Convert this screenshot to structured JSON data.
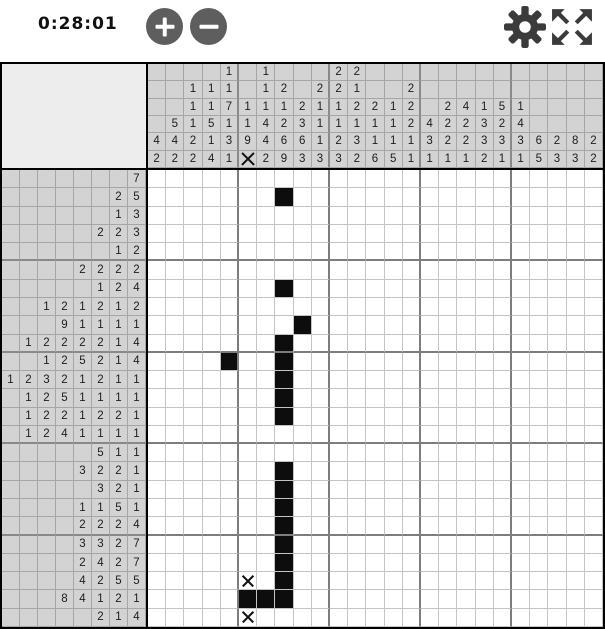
{
  "toolbar": {
    "timer": "0:28:01",
    "zoom_in": "zoom in",
    "zoom_out": "zoom out",
    "settings": "settings",
    "fullscreen": "fullscreen"
  },
  "colors": {
    "filled_cell": "#0d0d0d",
    "clue_background": "#d3d3d3",
    "corner_background": "#ededed",
    "button_gray": "#5e5e5e",
    "icon_gray": "#3b3b3b"
  },
  "puzzle": {
    "grid": {
      "rows": 25,
      "cols": 25
    },
    "column_clues": [
      [
        "4",
        "2"
      ],
      [
        "5",
        "4",
        "2"
      ],
      [
        "1",
        "1",
        "1",
        "2",
        "2"
      ],
      [
        "1",
        "1",
        "5",
        "1",
        "4"
      ],
      [
        "1",
        "1",
        "7",
        "1",
        "3",
        "1"
      ],
      [
        "1",
        "1",
        "9",
        "X"
      ],
      [
        "1",
        "1",
        "1",
        "4",
        "4",
        "2"
      ],
      [
        "2",
        "1",
        "2",
        "6",
        "9"
      ],
      [
        "2",
        "3",
        "6",
        "3"
      ],
      [
        "2",
        "1",
        "1",
        "1",
        "3"
      ],
      [
        "2",
        "2",
        "1",
        "1",
        "2",
        "3"
      ],
      [
        "2",
        "1",
        "2",
        "1",
        "3",
        "2"
      ],
      [
        "2",
        "1",
        "1",
        "6"
      ],
      [
        "1",
        "1",
        "1",
        "5"
      ],
      [
        "2",
        "2",
        "2",
        "1",
        "1"
      ],
      [
        "4",
        "3",
        "1"
      ],
      [
        "2",
        "2",
        "2",
        "1"
      ],
      [
        "4",
        "2",
        "2",
        "1"
      ],
      [
        "1",
        "3",
        "3",
        "2"
      ],
      [
        "5",
        "2",
        "3",
        "1"
      ],
      [
        "1",
        "4",
        "3",
        "1"
      ],
      [
        "6",
        "5"
      ],
      [
        "2",
        "3"
      ],
      [
        "8",
        "3"
      ],
      [
        "2",
        "2"
      ]
    ],
    "row_clues": [
      [
        "7"
      ],
      [
        "2",
        "5"
      ],
      [
        "1",
        "3"
      ],
      [
        "2",
        "2",
        "3"
      ],
      [
        "1",
        "2"
      ],
      [
        "2",
        "2",
        "2",
        "2"
      ],
      [
        "1",
        "2",
        "4"
      ],
      [
        "1",
        "2",
        "1",
        "2",
        "1",
        "2"
      ],
      [
        "9",
        "1",
        "1",
        "1",
        "1"
      ],
      [
        "1",
        "2",
        "2",
        "2",
        "2",
        "1",
        "4"
      ],
      [
        "1",
        "2",
        "5",
        "2",
        "1",
        "4"
      ],
      [
        "1",
        "2",
        "3",
        "2",
        "1",
        "2",
        "1",
        "1"
      ],
      [
        "1",
        "2",
        "5",
        "1",
        "1",
        "1",
        "1"
      ],
      [
        "1",
        "2",
        "2",
        "1",
        "2",
        "2",
        "1"
      ],
      [
        "1",
        "2",
        "4",
        "1",
        "1",
        "1",
        "1"
      ],
      [
        "5",
        "1",
        "1"
      ],
      [
        "3",
        "2",
        "2",
        "1"
      ],
      [
        "3",
        "2",
        "1"
      ],
      [
        "1",
        "1",
        "5",
        "1"
      ],
      [
        "2",
        "2",
        "2",
        "4"
      ],
      [
        "3",
        "3",
        "2",
        "7"
      ],
      [
        "2",
        "4",
        "2",
        "7"
      ],
      [
        "4",
        "2",
        "5",
        "5"
      ],
      [
        "8",
        "4",
        "1",
        "2",
        "1"
      ],
      [
        "2",
        "1",
        "4"
      ]
    ],
    "filled_cells": [
      [
        2,
        8
      ],
      [
        7,
        8
      ],
      [
        9,
        9
      ],
      [
        10,
        8
      ],
      [
        11,
        5
      ],
      [
        11,
        8
      ],
      [
        12,
        8
      ],
      [
        13,
        8
      ],
      [
        14,
        8
      ],
      [
        17,
        8
      ],
      [
        18,
        8
      ],
      [
        19,
        8
      ],
      [
        20,
        8
      ],
      [
        21,
        8
      ],
      [
        22,
        8
      ],
      [
        23,
        8
      ],
      [
        24,
        6
      ],
      [
        24,
        7
      ],
      [
        24,
        8
      ]
    ],
    "x_cells": [
      [
        23,
        6
      ],
      [
        25,
        6
      ]
    ]
  }
}
